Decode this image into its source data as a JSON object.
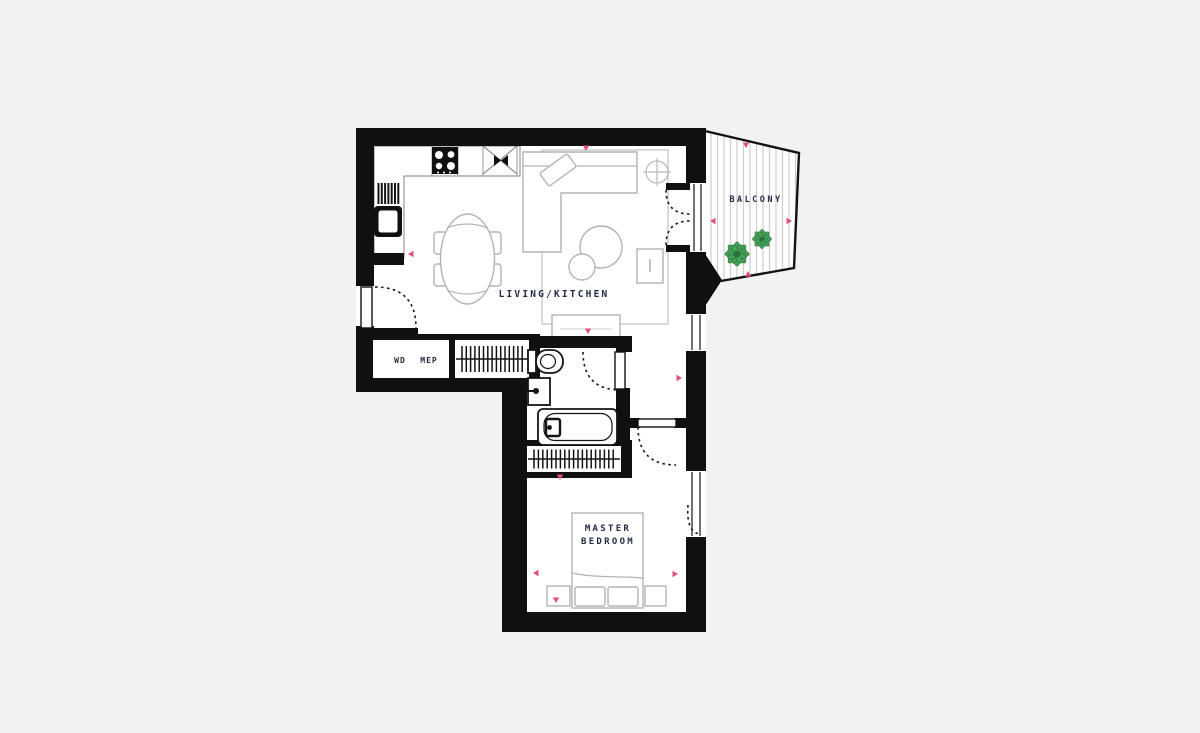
{
  "title": "Apartment floor plan",
  "labels": {
    "living_kitchen": "LIVING/KITCHEN",
    "balcony": "BALCONY",
    "master_bedroom_line1": "MASTER",
    "master_bedroom_line2": "BEDROOM",
    "utility_wd": "WD",
    "utility_mep": "MEP"
  },
  "rooms": [
    {
      "name": "Living/Kitchen"
    },
    {
      "name": "Balcony"
    },
    {
      "name": "Master Bedroom"
    },
    {
      "name": "Bathroom"
    },
    {
      "name": "WD MEP closet"
    }
  ],
  "colors": {
    "background": "#f2f2f2",
    "floor": "#ffffff",
    "wall": "#101010",
    "furniture_line": "#b3b3b3",
    "fixture_line": "#141414",
    "label_text": "#232b45",
    "marker_pink": "#e0507a",
    "plant_green": "#3d9e50",
    "plant_green_dark": "#27713a",
    "balcony_stripe": "#cdcdcd"
  }
}
